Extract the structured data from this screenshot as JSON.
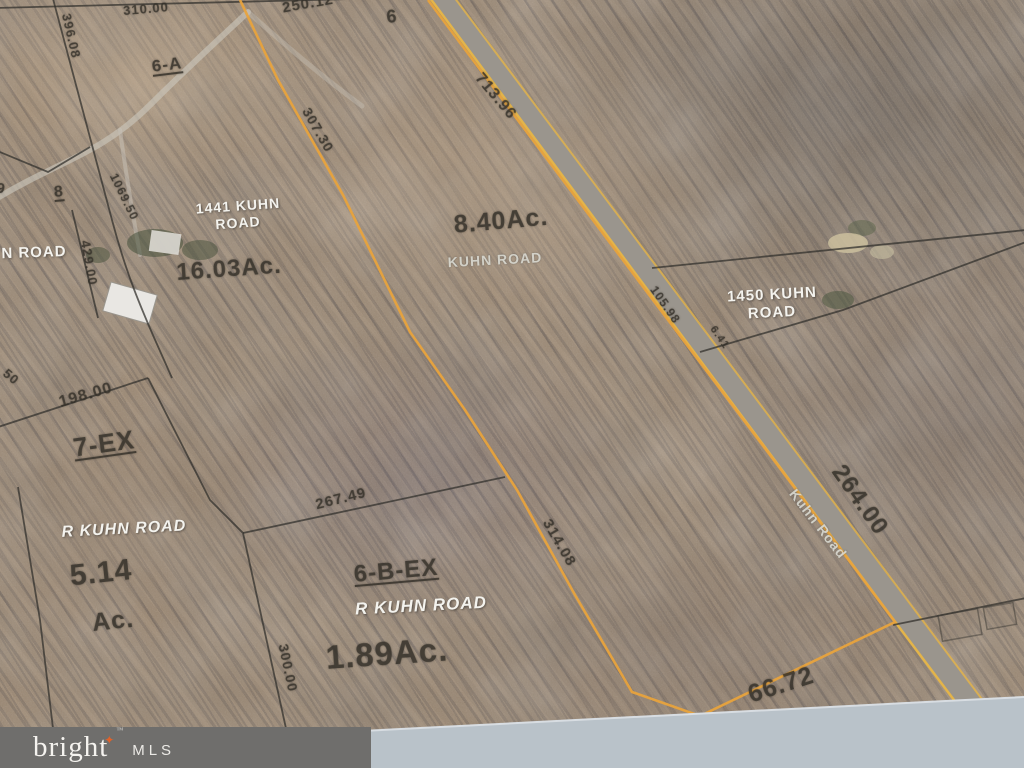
{
  "colors": {
    "parcel_outline": "#e8a33d",
    "boundary_line": "#33312e",
    "road_fill": "#9a958d",
    "road_edge": "#e3b44a",
    "photo_margin": "#b9c2c9",
    "footer_bar": "#6f6e6c",
    "footer_text": "#f5f3ef",
    "footer_star": "#e0622a"
  },
  "map": {
    "labels": [
      {
        "name": "dim-310-00",
        "text": "310.00",
        "x": 146,
        "y": 9,
        "rot": -5,
        "size": 13,
        "style": "dark"
      },
      {
        "name": "dim-396-08",
        "text": "396.08",
        "x": 71,
        "y": 36,
        "rot": 77,
        "size": 13,
        "style": "dark"
      },
      {
        "name": "dim-250-12",
        "text": "250.12",
        "x": 308,
        "y": 4,
        "rot": -10,
        "size": 15,
        "style": "dark"
      },
      {
        "name": "lot-6",
        "text": "6",
        "x": 392,
        "y": 17,
        "rot": -5,
        "size": 18,
        "style": "dark"
      },
      {
        "name": "lot-6-a",
        "text": "6-A",
        "x": 167,
        "y": 65,
        "rot": -7,
        "size": 17,
        "style": "dark",
        "underline": true
      },
      {
        "name": "dim-713-96",
        "text": "713.96",
        "x": 495,
        "y": 97,
        "rot": 50,
        "size": 16,
        "style": "dark"
      },
      {
        "name": "dim-307-30",
        "text": "307.30",
        "x": 318,
        "y": 130,
        "rot": 60,
        "size": 14,
        "style": "dark"
      },
      {
        "name": "lot-9",
        "text": "9",
        "x": 1,
        "y": 189,
        "rot": 10,
        "size": 15,
        "style": "dark"
      },
      {
        "name": "lot-8",
        "text": "8",
        "x": 59,
        "y": 193,
        "rot": -5,
        "size": 16,
        "style": "dark",
        "underline": true
      },
      {
        "name": "dim-1069-50",
        "text": "1069.50",
        "x": 124,
        "y": 197,
        "rot": 64,
        "size": 12,
        "style": "dark"
      },
      {
        "name": "dim-429-00",
        "text": "429.00",
        "x": 89,
        "y": 263,
        "rot": 80,
        "size": 13,
        "style": "dark"
      },
      {
        "name": "addr-1441-kuhn",
        "text": "1441 KUHN",
        "x": 238,
        "y": 206,
        "rot": -4,
        "size": 14,
        "style": "white"
      },
      {
        "name": "addr-1441-road",
        "text": "ROAD",
        "x": 238,
        "y": 223,
        "rot": -4,
        "size": 14,
        "style": "white"
      },
      {
        "name": "area-16-03-ac",
        "text": "16.03Ac.",
        "x": 229,
        "y": 269,
        "rot": -4,
        "size": 24,
        "style": "dark"
      },
      {
        "name": "area-8-40-ac",
        "text": "8.40Ac.",
        "x": 501,
        "y": 221,
        "rot": -5,
        "size": 25,
        "style": "dark"
      },
      {
        "name": "road-kuhn-center",
        "text": "KUHN ROAD",
        "x": 495,
        "y": 260,
        "rot": -3,
        "size": 14,
        "style": "road"
      },
      {
        "name": "road-n-road-left",
        "text": "N ROAD",
        "x": 34,
        "y": 253,
        "rot": -2,
        "size": 15,
        "style": "white"
      },
      {
        "name": "addr-1450-kuhn",
        "text": "1450 KUHN",
        "x": 772,
        "y": 295,
        "rot": -3,
        "size": 15,
        "style": "white"
      },
      {
        "name": "addr-1450-road",
        "text": "ROAD",
        "x": 772,
        "y": 313,
        "rot": -3,
        "size": 15,
        "style": "white"
      },
      {
        "name": "dim-105-98",
        "text": "105.98",
        "x": 665,
        "y": 305,
        "rot": 55,
        "size": 12,
        "style": "dark"
      },
      {
        "name": "dim-6-41",
        "text": "6.41",
        "x": 719,
        "y": 338,
        "rot": 55,
        "size": 11,
        "style": "dark"
      },
      {
        "name": "dim-50",
        "text": "50",
        "x": 11,
        "y": 377,
        "rot": 40,
        "size": 13,
        "style": "dark"
      },
      {
        "name": "dim-198-00",
        "text": "198.00",
        "x": 86,
        "y": 396,
        "rot": -16,
        "size": 16,
        "style": "dark"
      },
      {
        "name": "lot-7-ex",
        "text": "7-EX",
        "x": 104,
        "y": 444,
        "rot": -8,
        "size": 26,
        "style": "dark",
        "underline": true
      },
      {
        "name": "dim-267-49",
        "text": "267.49",
        "x": 341,
        "y": 499,
        "rot": -14,
        "size": 15,
        "style": "dark"
      },
      {
        "name": "road-r-kuhn-road-west",
        "text": "R KUHN ROAD",
        "x": 124,
        "y": 530,
        "rot": -3,
        "size": 16,
        "style": "white",
        "italic": true
      },
      {
        "name": "area-5-14",
        "text": "5.14",
        "x": 101,
        "y": 573,
        "rot": -6,
        "size": 30,
        "style": "dark"
      },
      {
        "name": "area-5-14-ac",
        "text": "Ac.",
        "x": 113,
        "y": 621,
        "rot": -6,
        "size": 25,
        "style": "dark"
      },
      {
        "name": "dim-314-08",
        "text": "314.08",
        "x": 559,
        "y": 543,
        "rot": 60,
        "size": 15,
        "style": "dark"
      },
      {
        "name": "lot-6-b-ex",
        "text": "6-B-EX",
        "x": 396,
        "y": 571,
        "rot": -5,
        "size": 24,
        "style": "dark",
        "underline": true
      },
      {
        "name": "road-r-kuhn-road-south",
        "text": "R KUHN ROAD",
        "x": 421,
        "y": 606,
        "rot": -3,
        "size": 17,
        "style": "white",
        "italic": true
      },
      {
        "name": "area-1-89-ac",
        "text": "1.89Ac.",
        "x": 387,
        "y": 654,
        "rot": -4,
        "size": 33,
        "style": "dark"
      },
      {
        "name": "dim-300-00",
        "text": "300.00",
        "x": 288,
        "y": 668,
        "rot": 78,
        "size": 14,
        "style": "dark"
      },
      {
        "name": "dim-264-00",
        "text": "264.00",
        "x": 860,
        "y": 500,
        "rot": 55,
        "size": 24,
        "style": "dark"
      },
      {
        "name": "road-kuhn-road-label",
        "text": "Kuhn Road",
        "x": 818,
        "y": 524,
        "rot": 52,
        "size": 14,
        "style": "road"
      },
      {
        "name": "dim-66-72",
        "text": "66.72",
        "x": 781,
        "y": 685,
        "rot": -18,
        "size": 25,
        "style": "dark"
      }
    ]
  },
  "footer": {
    "brand": "bright",
    "tm": "™",
    "suffix": "MLS"
  }
}
